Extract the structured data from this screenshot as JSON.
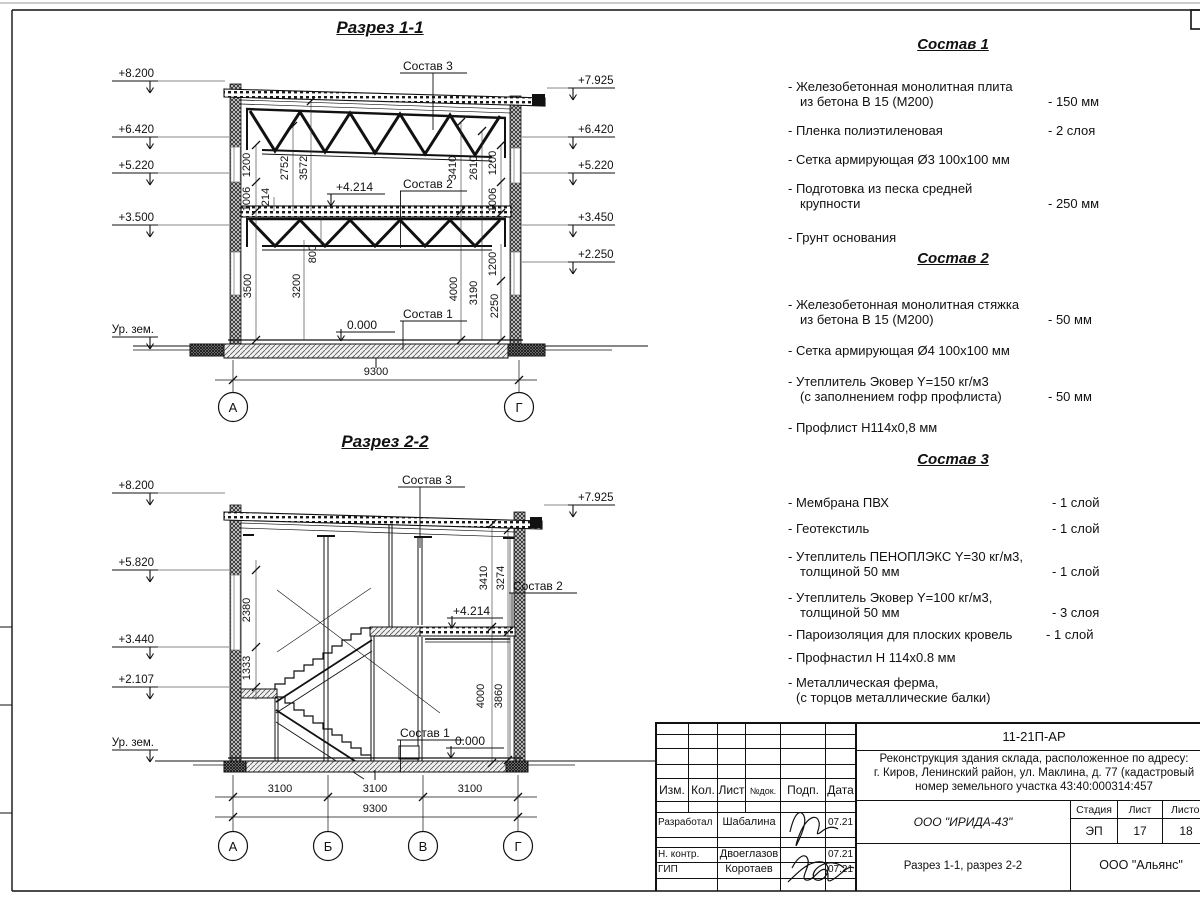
{
  "sections": {
    "s1": {
      "title": "Разрез 1-1",
      "left_marks": [
        "+8.200",
        "+6.420",
        "+5.220",
        "+3.500",
        "Ур. зем."
      ],
      "right_marks": [
        "+7.925",
        "+6.420",
        "+5.220",
        "+3.450",
        "+2.250"
      ],
      "sostav1": "Состав 1",
      "sostav2": "Состав 2",
      "sostav3": "Состав 3",
      "elev_mid": "+4.214",
      "elev_zero": "0.000",
      "dims_l": [
        "1200",
        "1006",
        "214",
        "2752",
        "3572",
        "800",
        "3500",
        "3200"
      ],
      "dims_r": [
        "3410",
        "2610",
        "1200",
        "1006",
        "4000",
        "3190",
        "1200",
        "2250"
      ],
      "total": "9300",
      "axes": [
        "А",
        "Г"
      ]
    },
    "s2": {
      "title": "Разрез 2-2",
      "left_marks": [
        "+8.200",
        "+5.820",
        "+3.440",
        "+2.107",
        "Ур. зем."
      ],
      "right_marks": [
        "+7.925"
      ],
      "sostav1": "Состав 1",
      "sostav2": "Состав 2",
      "sostav3": "Состав 3",
      "elev_mid": "+4.214",
      "elev_zero": "0.000",
      "dims_l": [
        "2380",
        "1333"
      ],
      "dims_r": [
        "3410",
        "3274",
        "4000",
        "3860"
      ],
      "bays": [
        "3100",
        "3100",
        "3100"
      ],
      "total": "9300",
      "axes": [
        "А",
        "Б",
        "В",
        "Г"
      ]
    }
  },
  "lists": [
    {
      "title": "Состав 1",
      "items": [
        {
          "l1": "- Железобетонная  монолитная плита",
          "l2": "из бетона В 15 (М200)",
          "val": "- 150 мм"
        },
        {
          "l1": "- Пленка полиэтиленовая",
          "val": "-  2 слоя"
        },
        {
          "l1": "- Сетка армирующая Ø3 100х100 мм"
        },
        {
          "l1": "- Подготовка из песка средней",
          "l2": "крупности",
          "val": "- 250 мм"
        },
        {
          "l1": "- Грунт основания"
        }
      ]
    },
    {
      "title": "Состав 2",
      "items": [
        {
          "l1": "- Железобетонная  монолитная стяжка",
          "l2": "из бетона В 15 (М200)",
          "val": "- 50 мм"
        },
        {
          "l1": "- Сетка армирующая Ø4 100х100 мм"
        },
        {
          "l1": "- Утеплитель Эковер Y=150 кг/м3",
          "l2": "(с заполнением гофр профлиста)",
          "val": "- 50 мм"
        },
        {
          "l1": "- Профлист Н114х0,8 мм"
        }
      ]
    },
    {
      "title": "Состав 3",
      "items": [
        {
          "l1": "- Мембрана ПВХ",
          "val": "- 1 слой"
        },
        {
          "l1": "- Геотекстиль",
          "val": "- 1 слой"
        },
        {
          "l1": "- Утеплитель ПЕНОПЛЭКС Y=30 кг/м3,",
          "l2": "толщиной 50 мм",
          "val": "- 1 слой"
        },
        {
          "l1": "- Утеплитель Эковер Y=100 кг/м3,",
          "l2": "толщиной 50 мм",
          "val": "- 3 слоя"
        },
        {
          "l1": "- Пароизоляция для плоских кровель",
          "val": "- 1 слой"
        },
        {
          "l1": "- Профнастил Н 114х0.8 мм"
        },
        {
          "l1": "- Металлическая ферма,",
          "l2": "(с торцов металлические балки)"
        }
      ]
    }
  ],
  "titleblock": {
    "code": "11-21П-АР",
    "project_lines": [
      "Реконструкция здания склада, расположенное по адресу:",
      "г. Киров, Ленинский район, ул. Маклина, д. 77 (кадастровый",
      "номер земельного участка 43:40:000314:457"
    ],
    "headers": [
      "Изм.",
      "Кол.",
      "Лист",
      "№док.",
      "Подп.",
      "Дата"
    ],
    "rows": [
      {
        "role": "Разработал",
        "name": "Шабалина",
        "date": "07.21"
      },
      {
        "role": "Н. контр.",
        "name": "Двоеглазов",
        "date": "07.21"
      },
      {
        "role": "ГИП",
        "name": "Коротаев",
        "date": "07.21"
      }
    ],
    "org": "ООО \"ИРИДА-43\"",
    "stage_label": "Стадия",
    "sheet_label": "Лист",
    "sheets_label": "Листов",
    "stage": "ЭП",
    "sheet": "17",
    "sheets": "18",
    "sheet_title": "Разрез 1-1, разрез 2-2",
    "company": "ООО \"Альянс\""
  }
}
